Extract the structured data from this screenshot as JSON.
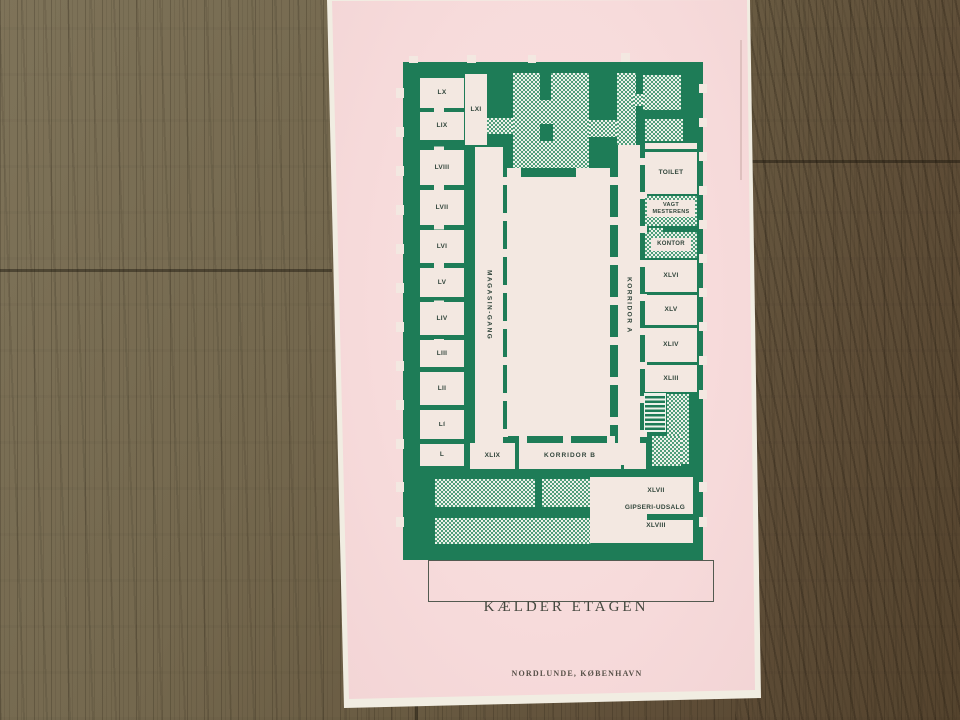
{
  "colors": {
    "plan_green": "#1e7c57",
    "hatch_green": "#4f9e7a",
    "hatch_paper": "#edf2ea",
    "room_cream": "#f3e8e1",
    "paper_pink": "#f7dbdb",
    "label_ink": "#31453b",
    "caption_ink": "#45483f",
    "imprint_ink": "#575048"
  },
  "plan": {
    "left_rooms": [
      "LX",
      "LIX",
      "LVIII",
      "LVII",
      "LVI",
      "LV",
      "LIV",
      "LIII",
      "LII",
      "LI",
      "L"
    ],
    "room_lxi": "LXI",
    "corridor_magasin": "MAGASIN-GANG",
    "corridor_a": "KORRIDOR A",
    "corridor_b": "KORRIDOR B",
    "room_xlix": "XLIX",
    "right_rooms": {
      "toilet": "TOILET",
      "vagtmesterens": "VAGT MESTERENS",
      "kontor": "KONTOR",
      "xlvi": "XLVI",
      "xlv": "XLV",
      "xliv": "XLIV",
      "xliii": "XLIII"
    },
    "bottom_rooms": {
      "xlvii": "XLVII",
      "gipseri": "GIPSERI-UDSALG",
      "xlviii": "XLVIII"
    }
  },
  "caption": "KÆLDER ETAGEN",
  "imprint": "NORDLUNDE, KØBENHAVN"
}
